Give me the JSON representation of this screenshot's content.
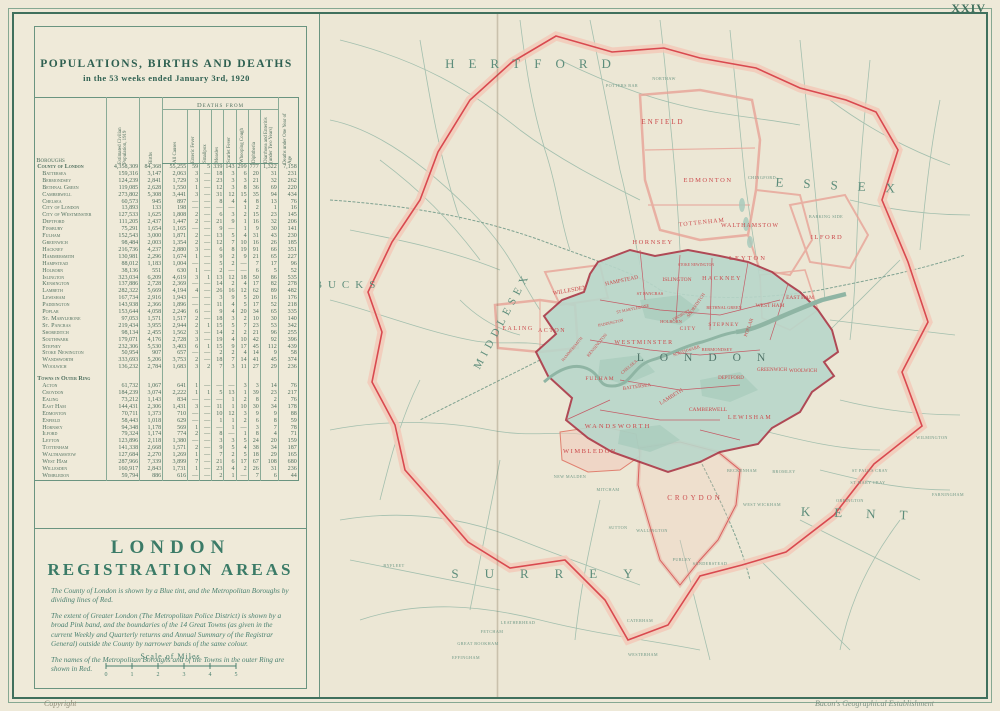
{
  "page": {
    "folio": "XXIV",
    "copyright": "Copyright",
    "imprint": "Bacon's Geographical Establishment"
  },
  "table": {
    "title": "POPULATIONS, BIRTHS AND DEATHS",
    "subtitle": "in the 53 weeks ended January 3rd, 1920",
    "first_col": "Boroughs",
    "group_header": "Deaths from",
    "rot_columns": [
      "Estimated Civilian Population, 1919",
      "Births",
      "All Causes",
      "Enteric Fever",
      "Smallpox",
      "Measles",
      "Scarlet Fever",
      "Whooping Cough",
      "Diphtheria",
      "Diarrhoea and Enteritis (under Two Years)",
      "Deaths under One Year of Age"
    ],
    "rows": [
      {
        "label": "County of London",
        "bold": true,
        "values": [
          "4,358,309",
          "84,368",
          "55,255",
          "59",
          "5",
          "339",
          "143",
          "299",
          "777",
          "1,322",
          "7,158"
        ]
      },
      {
        "label": "Battersea",
        "values": [
          "159,316",
          "3,147",
          "2,063",
          "3",
          "—",
          "18",
          "3",
          "6",
          "20",
          "31",
          "231"
        ]
      },
      {
        "label": "Bermondsey",
        "values": [
          "124,239",
          "2,841",
          "1,729",
          "3",
          "—",
          "23",
          "3",
          "3",
          "21",
          "32",
          "262"
        ]
      },
      {
        "label": "Bethnal Green",
        "values": [
          "119,085",
          "2,628",
          "1,550",
          "1",
          "—",
          "12",
          "3",
          "8",
          "36",
          "69",
          "220"
        ]
      },
      {
        "label": "Camberwell",
        "values": [
          "273,802",
          "5,308",
          "3,441",
          "3",
          "—",
          "31",
          "12",
          "15",
          "35",
          "94",
          "434"
        ]
      },
      {
        "label": "Chelsea",
        "values": [
          "60,573",
          "945",
          "897",
          "—",
          "—",
          "8",
          "4",
          "4",
          "8",
          "13",
          "76"
        ]
      },
      {
        "label": "City of London",
        "values": [
          "13,893",
          "133",
          "198",
          "—",
          "—",
          "—",
          "—",
          "1",
          "2",
          "1",
          "16"
        ]
      },
      {
        "label": "City of Westminster",
        "values": [
          "127,533",
          "1,625",
          "1,808",
          "2",
          "—",
          "6",
          "3",
          "2",
          "15",
          "23",
          "145"
        ]
      },
      {
        "label": "Deptford",
        "values": [
          "111,205",
          "2,437",
          "1,447",
          "2",
          "—",
          "21",
          "9",
          "1",
          "16",
          "32",
          "206"
        ]
      },
      {
        "label": "Finsbury",
        "values": [
          "75,291",
          "1,654",
          "1,165",
          "—",
          "—",
          "9",
          "—",
          "1",
          "9",
          "30",
          "141"
        ]
      },
      {
        "label": "Fulham",
        "values": [
          "152,543",
          "3,000",
          "1,871",
          "2",
          "—",
          "13",
          "5",
          "4",
          "31",
          "43",
          "230"
        ]
      },
      {
        "label": "Greenwich",
        "values": [
          "98,484",
          "2,003",
          "1,354",
          "2",
          "—",
          "12",
          "7",
          "10",
          "16",
          "26",
          "185"
        ]
      },
      {
        "label": "Hackney",
        "values": [
          "216,736",
          "4,237",
          "2,880",
          "3",
          "—",
          "6",
          "8",
          "19",
          "91",
          "66",
          "351"
        ]
      },
      {
        "label": "Hammersmith",
        "values": [
          "130,981",
          "2,296",
          "1,674",
          "1",
          "—",
          "9",
          "2",
          "9",
          "21",
          "65",
          "227"
        ]
      },
      {
        "label": "Hampstead",
        "values": [
          "88,012",
          "1,183",
          "1,004",
          "—",
          "—",
          "5",
          "2",
          "—",
          "7",
          "17",
          "96"
        ]
      },
      {
        "label": "Holborn",
        "values": [
          "38,136",
          "551",
          "630",
          "1",
          "—",
          "2",
          "—",
          "—",
          "6",
          "5",
          "52"
        ]
      },
      {
        "label": "Islington",
        "values": [
          "323,034",
          "6,209",
          "4,619",
          "3",
          "1",
          "13",
          "12",
          "18",
          "50",
          "86",
          "535"
        ]
      },
      {
        "label": "Kensington",
        "values": [
          "137,886",
          "2,728",
          "2,369",
          "—",
          "—",
          "14",
          "2",
          "4",
          "17",
          "82",
          "278"
        ]
      },
      {
        "label": "Lambeth",
        "values": [
          "282,322",
          "5,669",
          "4,194",
          "4",
          "—",
          "26",
          "16",
          "12",
          "62",
          "89",
          "482"
        ]
      },
      {
        "label": "Lewisham",
        "values": [
          "167,734",
          "2,916",
          "1,943",
          "—",
          "—",
          "3",
          "9",
          "5",
          "20",
          "16",
          "176"
        ]
      },
      {
        "label": "Paddington",
        "values": [
          "143,938",
          "2,366",
          "1,896",
          "—",
          "—",
          "11",
          "4",
          "5",
          "17",
          "52",
          "218"
        ]
      },
      {
        "label": "Poplar",
        "values": [
          "153,644",
          "4,058",
          "2,246",
          "6",
          "—",
          "9",
          "4",
          "20",
          "34",
          "65",
          "335"
        ]
      },
      {
        "label": "St. Marylebone",
        "values": [
          "97,053",
          "1,571",
          "1,517",
          "2",
          "—",
          "18",
          "3",
          "2",
          "10",
          "30",
          "140"
        ]
      },
      {
        "label": "St. Pancras",
        "values": [
          "219,434",
          "3,955",
          "2,944",
          "2",
          "1",
          "15",
          "5",
          "7",
          "23",
          "53",
          "342"
        ]
      },
      {
        "label": "Shoreditch",
        "values": [
          "98,134",
          "2,455",
          "1,562",
          "3",
          "—",
          "14",
          "2",
          "2",
          "21",
          "96",
          "255"
        ]
      },
      {
        "label": "Southwark",
        "values": [
          "179,071",
          "4,176",
          "2,728",
          "3",
          "—",
          "19",
          "4",
          "10",
          "42",
          "92",
          "396"
        ]
      },
      {
        "label": "Stepney",
        "values": [
          "232,306",
          "5,530",
          "3,403",
          "6",
          "1",
          "15",
          "9",
          "17",
          "45",
          "112",
          "439"
        ]
      },
      {
        "label": "Stoke Newington",
        "values": [
          "50,954",
          "907",
          "657",
          "—",
          "—",
          "2",
          "2",
          "4",
          "14",
          "9",
          "58"
        ]
      },
      {
        "label": "Wandsworth",
        "values": [
          "333,693",
          "5,206",
          "3,753",
          "2",
          "—",
          "18",
          "7",
          "14",
          "41",
          "45",
          "374"
        ]
      },
      {
        "label": "Woolwich",
        "values": [
          "136,232",
          "2,784",
          "1,683",
          "3",
          "2",
          "7",
          "3",
          "11",
          "27",
          "29",
          "236"
        ]
      },
      {
        "label": "Towns in Outer Ring",
        "section": true
      },
      {
        "label": "Acton",
        "values": [
          "61,732",
          "1,067",
          "641",
          "1",
          "—",
          "—",
          "—",
          "3",
          "3",
          "14",
          "76"
        ]
      },
      {
        "label": "Croydon",
        "values": [
          "184,239",
          "3,074",
          "2,222",
          "1",
          "1",
          "5",
          "13",
          "1",
          "39",
          "23",
          "217"
        ]
      },
      {
        "label": "Ealing",
        "values": [
          "73,212",
          "1,143",
          "834",
          "—",
          "—",
          "—",
          "1",
          "2",
          "8",
          "2",
          "76"
        ]
      },
      {
        "label": "East Ham",
        "values": [
          "144,431",
          "2,306",
          "1,431",
          "3",
          "—",
          "11",
          "1",
          "10",
          "30",
          "34",
          "178"
        ]
      },
      {
        "label": "Edmonton",
        "values": [
          "70,711",
          "1,373",
          "710",
          "—",
          "—",
          "10",
          "12",
          "3",
          "9",
          "9",
          "88"
        ]
      },
      {
        "label": "Enfield",
        "values": [
          "58,443",
          "1,018",
          "629",
          "—",
          "—",
          "1",
          "1",
          "2",
          "6",
          "8",
          "59"
        ]
      },
      {
        "label": "Hornsey",
        "values": [
          "94,348",
          "1,178",
          "569",
          "1",
          "—",
          "—",
          "1",
          "—",
          "3",
          "7",
          "78"
        ]
      },
      {
        "label": "Ilford",
        "values": [
          "79,324",
          "1,174",
          "774",
          "2",
          "—",
          "8",
          "—",
          "1",
          "8",
          "4",
          "71"
        ]
      },
      {
        "label": "Leyton",
        "values": [
          "123,896",
          "2,118",
          "1,380",
          "—",
          "—",
          "3",
          "3",
          "5",
          "24",
          "20",
          "159"
        ]
      },
      {
        "label": "Tottenham",
        "values": [
          "141,338",
          "2,668",
          "1,571",
          "2",
          "—",
          "9",
          "5",
          "4",
          "38",
          "34",
          "187"
        ]
      },
      {
        "label": "Walthamstow",
        "values": [
          "127,684",
          "2,270",
          "1,269",
          "1",
          "—",
          "7",
          "2",
          "5",
          "18",
          "29",
          "165"
        ]
      },
      {
        "label": "West Ham",
        "values": [
          "287,966",
          "7,339",
          "3,899",
          "7",
          "—",
          "21",
          "6",
          "17",
          "67",
          "108",
          "680"
        ]
      },
      {
        "label": "Willesden",
        "values": [
          "160,917",
          "2,843",
          "1,731",
          "1",
          "—",
          "23",
          "4",
          "2",
          "26",
          "31",
          "236"
        ]
      },
      {
        "label": "Wimbledon",
        "values": [
          "59,794",
          "886",
          "616",
          "—",
          "—",
          "2",
          "1",
          "—",
          "7",
          "6",
          "44"
        ]
      }
    ]
  },
  "legend": {
    "title_line1": "LONDON",
    "title_line2": "REGISTRATION AREAS",
    "paragraphs": [
      "The County of London is shown by a Blue tint, and the Metropolitan Boroughs by dividing lines of Red.",
      "The extent of Greater London (The Metropolitan Police District) is shown by a broad Pink band, and the boundaries of the 14 Great Towns (as given in the current Weekly and Quarterly returns and Annual Summary of the Registrar General) outside the County by narrower bands of the same colour.",
      "The names of the Metropolitan Boroughs and of the Towns in the outer Ring are shown in Red."
    ],
    "scale_label": "Scale of Miles",
    "scale_ticks": [
      "0",
      "1",
      "2",
      "3",
      "4",
      "5"
    ]
  },
  "map": {
    "counties": [
      "HERTFORD",
      "ESSEX",
      "BUCKS",
      "MIDDLESEX",
      "SURREY",
      "KENT"
    ],
    "center_label": "LONDON",
    "red_labels": [
      "ENFIELD",
      "EDMONTON",
      "TOTTENHAM",
      "WALTHAMSTOW",
      "ILFORD",
      "HORNSEY",
      "LEYTON",
      "EAST HAM",
      "WEST HAM",
      "WILLESDEN",
      "HAMPSTEAD",
      "ST PANCRAS",
      "ISLINGTON",
      "HACKNEY",
      "STOKE NEWINGTON",
      "SHOREDITCH",
      "BETHNAL GREEN",
      "FINSBURY",
      "HOLBORN",
      "CITY",
      "STEPNEY",
      "POPLAR",
      "ST MARYLEBONE",
      "PADDINGTON",
      "KENSINGTON",
      "HAMMERSMITH",
      "WESTMINSTER",
      "CHELSEA",
      "FULHAM",
      "BATTERSEA",
      "LAMBETH",
      "SOUTHWARK",
      "BERMONDSEY",
      "CAMBERWELL",
      "DEPTFORD",
      "GREENWICH",
      "WOOLWICH",
      "LEWISHAM",
      "WANDSWORTH",
      "WIMBLEDON",
      "CROYDON",
      "ACTON",
      "EALING"
    ],
    "places": [
      "POTTERS BAR",
      "NORTHAW",
      "CHINGFORD",
      "BARKING SIDE",
      "LEATHERHEAD",
      "FETCHAM",
      "GREAT BOOKHAM",
      "EFFINGHAM",
      "BYFLEET",
      "CATERHAM",
      "WESTERHAM",
      "BECKENHAM",
      "BROMLEY",
      "WEST WICKHAM",
      "SUTTON",
      "WALLINGTON",
      "MITCHAM",
      "NEW MALDEN",
      "PURLEY",
      "SANDERSTEAD",
      "FARNINGHAM",
      "WILMINGTON",
      "ST PAULS CRAY",
      "ST MARY CRAY",
      "ORPINGTON"
    ],
    "colors": {
      "county_tint": "#b9d6ca",
      "greater_london_band": "#f3c9b9",
      "boundary_red": "#d9494f",
      "label_red": "#cb4a4c",
      "road_green": "#a3bfae",
      "deep_green": "#3f6f5c"
    }
  }
}
